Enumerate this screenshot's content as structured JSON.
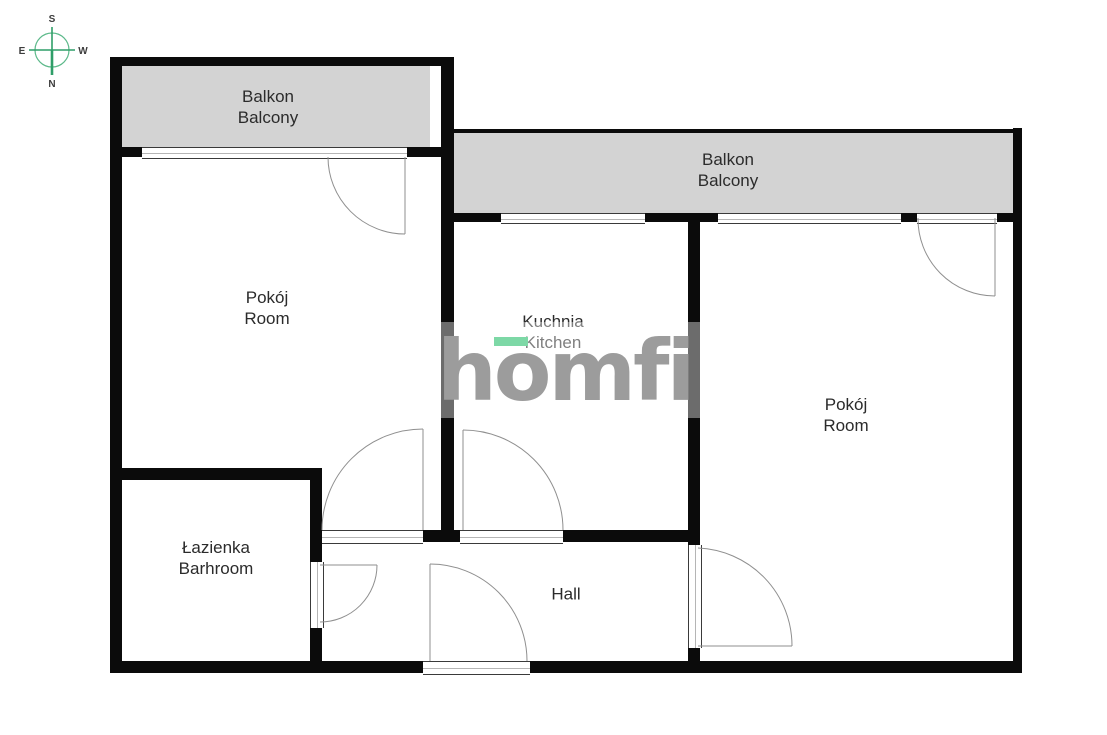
{
  "meta": {
    "title": "Apartment floor plan",
    "width": 1107,
    "height": 735
  },
  "colors": {
    "wall": "#0b0b0b",
    "balcony_fill": "#d3d3d3",
    "door_stroke": "#8f8f8f",
    "label_text": "#2b2b2b",
    "logo_gray": "#9c9c9c",
    "logo_green": "#7dd8a6",
    "compass_green": "#2f9e68"
  },
  "compass": {
    "labels": {
      "top": "S",
      "bottom": "N",
      "left": "E",
      "right": "W"
    }
  },
  "watermark": {
    "text": "homfi"
  },
  "rooms": [
    {
      "id": "balcony-left",
      "label_pl": "Balkon",
      "label_en": "Balcony",
      "cx": 268,
      "cy": 107
    },
    {
      "id": "balcony-right",
      "label_pl": "Balkon",
      "label_en": "Balcony",
      "cx": 728,
      "cy": 170
    },
    {
      "id": "room-left",
      "label_pl": "Pokój",
      "label_en": "Room",
      "cx": 267,
      "cy": 308
    },
    {
      "id": "kitchen",
      "label_pl": "Kuchnia",
      "label_en": "Kitchen",
      "cx": 553,
      "cy": 332
    },
    {
      "id": "room-right",
      "label_pl": "Pokój",
      "label_en": "Room",
      "cx": 846,
      "cy": 415
    },
    {
      "id": "bathroom",
      "label_pl": "Łazienka",
      "label_en": "Barhroom",
      "cx": 216,
      "cy": 558
    },
    {
      "id": "hall",
      "label_pl": "Hall",
      "label_en": "",
      "cx": 566,
      "cy": 594
    }
  ],
  "geometry": {
    "balconies": [
      {
        "id": "balcony-left-floor",
        "x": 122,
        "y": 65,
        "w": 308,
        "h": 83
      },
      {
        "id": "balcony-right-floor",
        "x": 450,
        "y": 133,
        "w": 563,
        "h": 80
      }
    ],
    "walls": [
      {
        "id": "outer-left",
        "x": 110,
        "y": 57,
        "w": 12,
        "h": 616
      },
      {
        "id": "outer-bottom-left",
        "x": 110,
        "y": 661,
        "w": 313,
        "h": 12
      },
      {
        "id": "outer-bottom-right",
        "x": 530,
        "y": 661,
        "w": 492,
        "h": 12
      },
      {
        "id": "outer-right",
        "x": 1013,
        "y": 128,
        "w": 9,
        "h": 545
      },
      {
        "id": "balcony-left-top",
        "x": 110,
        "y": 57,
        "w": 333,
        "h": 9
      },
      {
        "id": "center-left-vertical",
        "x": 441,
        "y": 57,
        "w": 13,
        "h": 485
      },
      {
        "id": "balcony-right-top",
        "x": 450,
        "y": 129,
        "w": 563,
        "h": 4
      },
      {
        "id": "kitchen-top-a",
        "x": 441,
        "y": 213,
        "w": 60,
        "h": 9
      },
      {
        "id": "kitchen-top-b",
        "x": 645,
        "y": 213,
        "w": 73,
        "h": 9
      },
      {
        "id": "room-right-top-a",
        "x": 901,
        "y": 213,
        "w": 16,
        "h": 9
      },
      {
        "id": "room-right-top-b",
        "x": 997,
        "y": 213,
        "w": 16,
        "h": 9
      },
      {
        "id": "left-window-notch-l",
        "x": 122,
        "y": 147,
        "w": 20,
        "h": 10
      },
      {
        "id": "left-window-notch-r",
        "x": 407,
        "y": 147,
        "w": 34,
        "h": 10
      },
      {
        "id": "kitchen-room-vert-up",
        "x": 688,
        "y": 213,
        "w": 12,
        "h": 332
      },
      {
        "id": "kitchen-room-vert-low",
        "x": 688,
        "y": 648,
        "w": 12,
        "h": 25
      },
      {
        "id": "hall-top-mid",
        "x": 423,
        "y": 530,
        "w": 37,
        "h": 12
      },
      {
        "id": "hall-top-right",
        "x": 563,
        "y": 530,
        "w": 125,
        "h": 12
      },
      {
        "id": "bathroom-top",
        "x": 110,
        "y": 468,
        "w": 212,
        "h": 12
      },
      {
        "id": "bathroom-right-up",
        "x": 310,
        "y": 468,
        "w": 12,
        "h": 94
      },
      {
        "id": "bathroom-right-low",
        "x": 310,
        "y": 628,
        "w": 12,
        "h": 45
      }
    ],
    "windows": [
      {
        "id": "window-room-left",
        "o": "h",
        "x": 142,
        "y": 147,
        "w": 265,
        "h": 10
      },
      {
        "id": "window-kitchen",
        "o": "h",
        "x": 501,
        "y": 213,
        "w": 144,
        "h": 9
      },
      {
        "id": "window-room-right",
        "o": "h",
        "x": 718,
        "y": 213,
        "w": 183,
        "h": 9
      },
      {
        "id": "threshold-balcony-door",
        "o": "h",
        "x": 917,
        "y": 213,
        "w": 80,
        "h": 9
      },
      {
        "id": "threshold-room-left",
        "o": "h",
        "x": 322,
        "y": 530,
        "w": 101,
        "h": 12
      },
      {
        "id": "threshold-kitchen",
        "o": "h",
        "x": 460,
        "y": 530,
        "w": 103,
        "h": 12
      },
      {
        "id": "threshold-entrance",
        "o": "h",
        "x": 423,
        "y": 661,
        "w": 107,
        "h": 12
      },
      {
        "id": "threshold-bathroom",
        "o": "v",
        "x": 310,
        "y": 562,
        "w": 12,
        "h": 66
      },
      {
        "id": "threshold-room-right",
        "o": "v",
        "x": 688,
        "y": 545,
        "w": 12,
        "h": 103
      }
    ],
    "doors": [
      {
        "id": "door-balcony-room-left",
        "arc": "M328,157 A77 77 0 0 0 405,234",
        "leaf": "M405,157 L405,234"
      },
      {
        "id": "door-balcony-room-right",
        "arc": "M918,218 A77 77 0 0 0 995,296",
        "leaf": "M995,218 L995,296"
      },
      {
        "id": "door-hall-room-left",
        "arc": "M322,530 A101 101 0 0 1 423,429",
        "leaf": "M423,429 L423,530"
      },
      {
        "id": "door-hall-kitchen",
        "arc": "M463,430 A100 100 0 0 1 563,530",
        "leaf": "M463,430 L463,530"
      },
      {
        "id": "door-hall-bathroom",
        "arc": "M377,565 A57 57 0 0 1 320,622",
        "leaf": "M320,565 L377,565"
      },
      {
        "id": "door-entrance",
        "arc": "M430,564 A97 97 0 0 1 527,661",
        "leaf": "M430,564 L430,661"
      },
      {
        "id": "door-hall-room-right",
        "arc": "M698,548 A98 98 0 0 1 792,646",
        "leaf": "M698,646 L792,646"
      }
    ]
  }
}
